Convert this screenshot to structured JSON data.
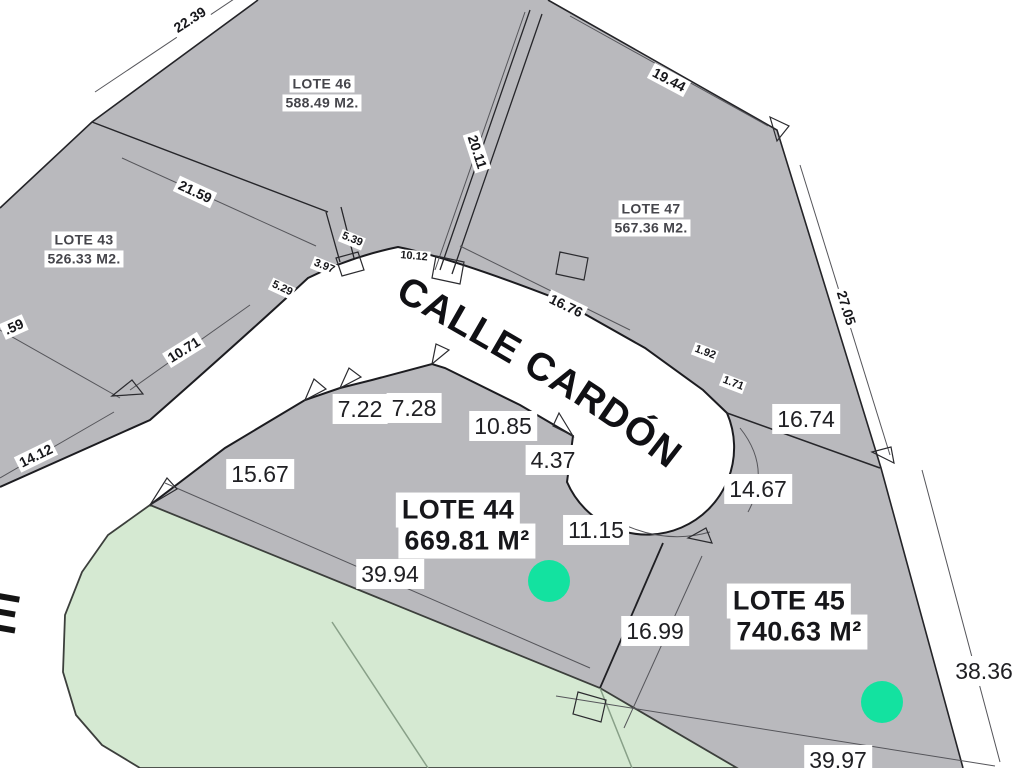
{
  "map": {
    "kind": "subdivision plat map"
  },
  "street": {
    "name": "CALLE CARDÓN",
    "cross_street_partial_letter": "E"
  },
  "lots": [
    {
      "id": "lote-43",
      "name": "LOTE 43",
      "area": "526.33 M2."
    },
    {
      "id": "lote-44",
      "name": "LOTE 44",
      "area": "669.81 M²"
    },
    {
      "id": "lote-45",
      "name": "LOTE 45",
      "area": "740.63 M²"
    },
    {
      "id": "lote-46",
      "name": "LOTE 46",
      "area": "588.49 M2."
    },
    {
      "id": "lote-47",
      "name": "LOTE 47",
      "area": "567.36 M2."
    }
  ],
  "dims": {
    "d22_39": "22.39",
    "d19_44": "19.44",
    "d21_59": "21.59",
    "d20_11": "20.11",
    "d27_05": "27.05",
    "d5_39": "5.39",
    "d10_12": "10.12",
    "d3_97": "3.97",
    "d5_29": "5.29",
    "d10_71": "10.71",
    "d14_12": "14.12",
    "d0_59": ".59",
    "d16_76": "16.76",
    "d1_92": "1.92",
    "d1_71": "1.71",
    "d16_74": "16.74",
    "d7_22": "7.22",
    "d7_28": "7.28",
    "d10_85": "10.85",
    "d4_37": "4.37",
    "d15_67": "15.67",
    "d14_67": "14.67",
    "d11_15": "11.15",
    "d39_94": "39.94",
    "d16_99": "16.99",
    "d38_36": "38.36",
    "d39_97": "39.97"
  },
  "colors": {
    "lot_fill": "#b9b9bd",
    "green_fill": "#d5e9d2",
    "marker_green": "#13e2a0",
    "street_white": "#ffffff",
    "line_dark": "#1f1f23"
  }
}
